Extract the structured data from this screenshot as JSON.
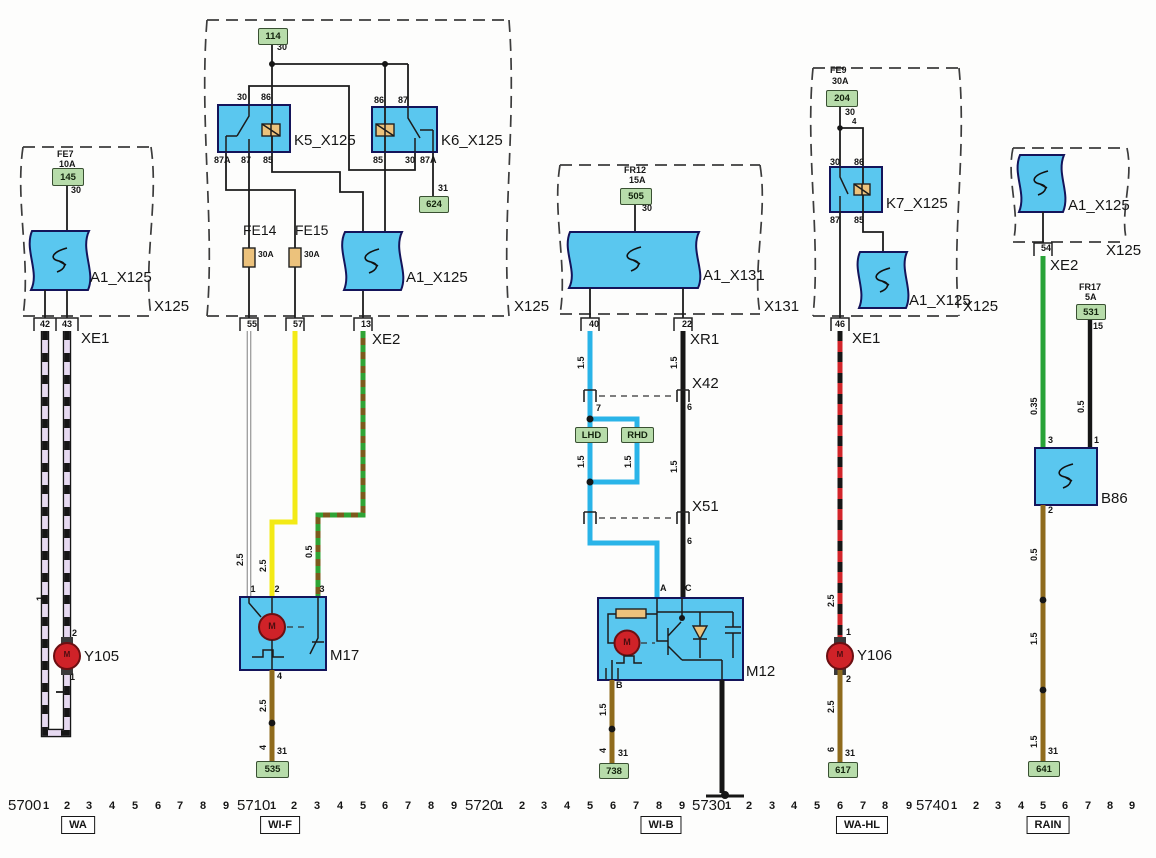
{
  "palette": {
    "bluebox": "#5ac7ef",
    "tan_fuse": "#ecc27c",
    "green_label_bg": "#b7dcaa",
    "lavender_wire": "#e6d9f0",
    "yellow_wire": "#f3ea16",
    "blue_wire": "#2ab4e8",
    "green_wire": "#28a337",
    "brown_wire": "#8f6b1d",
    "red_wire": "#d2252a",
    "motor_red": "#cf2228"
  },
  "labels": [
    [
      "fuse-label",
      "FE7",
      57,
      150,
      9,
      ""
    ],
    [
      "fuse-label",
      "10A",
      59,
      160,
      9,
      ""
    ],
    [
      "terminal-label",
      "30",
      71,
      186,
      9,
      ""
    ],
    [
      "component-label",
      "A1_X125",
      90,
      270,
      15,
      ""
    ],
    [
      "connector-label",
      "X125",
      154,
      299,
      15,
      ""
    ],
    [
      "pin-label",
      "42",
      45,
      320,
      9,
      "c"
    ],
    [
      "pin-label",
      "43",
      67,
      320,
      9,
      "c"
    ],
    [
      "connector-label",
      "XE1",
      81,
      331,
      15,
      ""
    ],
    [
      "wire-size-label",
      "1",
      36,
      601,
      9,
      "r"
    ],
    [
      "pin-label",
      "2",
      72,
      629,
      9,
      ""
    ],
    [
      "component-label",
      "Y105",
      84,
      649,
      15,
      ""
    ],
    [
      "pin-label",
      "1",
      70,
      673,
      9,
      ""
    ],
    [
      "terminal-label",
      "30",
      277,
      43,
      9,
      ""
    ],
    [
      "component-label",
      "K5_X125",
      294,
      133,
      15,
      ""
    ],
    [
      "component-label",
      "K6_X125",
      441,
      133,
      15,
      ""
    ],
    [
      "terminal-label",
      "30",
      237,
      93,
      9,
      ""
    ],
    [
      "terminal-label",
      "86",
      261,
      93,
      9,
      ""
    ],
    [
      "terminal-label",
      "87A",
      214,
      156,
      9,
      ""
    ],
    [
      "terminal-label",
      "87",
      241,
      156,
      9,
      ""
    ],
    [
      "terminal-label",
      "85",
      263,
      156,
      9,
      ""
    ],
    [
      "terminal-label",
      "86",
      374,
      96,
      9,
      ""
    ],
    [
      "terminal-label",
      "87",
      398,
      96,
      9,
      ""
    ],
    [
      "terminal-label",
      "85",
      373,
      156,
      9,
      ""
    ],
    [
      "terminal-label",
      "30",
      405,
      156,
      9,
      ""
    ],
    [
      "terminal-label",
      "87A",
      420,
      156,
      9,
      ""
    ],
    [
      "ground-terminal-label",
      "31",
      438,
      184,
      9,
      ""
    ],
    [
      "fuse-label",
      "FE14",
      243,
      223,
      14,
      ""
    ],
    [
      "fuse-label",
      "FE15",
      295,
      223,
      14,
      ""
    ],
    [
      "fuse-label",
      "30A",
      258,
      250,
      8.5,
      ""
    ],
    [
      "fuse-label",
      "30A",
      304,
      250,
      8.5,
      ""
    ],
    [
      "component-label",
      "A1_X125",
      406,
      270,
      15,
      ""
    ],
    [
      "connector-label",
      "X125",
      514,
      299,
      15,
      ""
    ],
    [
      "pin-label",
      "55",
      252,
      320,
      9,
      "c"
    ],
    [
      "pin-label",
      "57",
      298,
      320,
      9,
      "c"
    ],
    [
      "pin-label",
      "13",
      366,
      320,
      9,
      "c"
    ],
    [
      "connector-label",
      "XE2",
      372,
      332,
      15,
      ""
    ],
    [
      "wire-size-label",
      "2.5",
      236,
      566,
      9,
      "r"
    ],
    [
      "wire-size-label",
      "2.5",
      259,
      572,
      9,
      "r"
    ],
    [
      "wire-size-label",
      "0.5",
      305,
      558,
      9,
      "r"
    ],
    [
      "pin-label",
      "1",
      253,
      585,
      9,
      "c"
    ],
    [
      "pin-label",
      "2",
      277,
      585,
      9,
      "c"
    ],
    [
      "pin-label",
      "3",
      322,
      585,
      9,
      "c"
    ],
    [
      "component-label",
      "M17",
      330,
      648,
      15,
      ""
    ],
    [
      "pin-label",
      "4",
      277,
      672,
      9,
      ""
    ],
    [
      "wire-size-label",
      "2.5",
      259,
      712,
      9,
      "r"
    ],
    [
      "wire-size-label",
      "4",
      259,
      750,
      9,
      "r"
    ],
    [
      "ground-terminal-label",
      "31",
      277,
      747,
      9,
      ""
    ],
    [
      "fuse-label",
      "FR12",
      624,
      166,
      9,
      ""
    ],
    [
      "fuse-label",
      "15A",
      629,
      176,
      9,
      ""
    ],
    [
      "terminal-label",
      "30",
      642,
      204,
      9,
      ""
    ],
    [
      "component-label",
      "A1_X131",
      703,
      268,
      15,
      ""
    ],
    [
      "connector-label",
      "X131",
      764,
      299,
      15,
      ""
    ],
    [
      "pin-label",
      "40",
      594,
      320,
      9,
      "c"
    ],
    [
      "pin-label",
      "22",
      687,
      320,
      9,
      "c"
    ],
    [
      "connector-label",
      "XR1",
      690,
      332,
      15,
      ""
    ],
    [
      "wire-size-label",
      "1.5",
      577,
      369,
      9,
      "r"
    ],
    [
      "wire-size-label",
      "1.5",
      670,
      369,
      9,
      "r"
    ],
    [
      "connector-label",
      "X42",
      692,
      376,
      15,
      ""
    ],
    [
      "pin-label",
      "7",
      596,
      404,
      9,
      ""
    ],
    [
      "pin-label",
      "6",
      687,
      403,
      9,
      ""
    ],
    [
      "wire-size-label",
      "1.5",
      577,
      468,
      9,
      "r"
    ],
    [
      "wire-size-label",
      "1.5",
      624,
      468,
      9,
      "r"
    ],
    [
      "wire-size-label",
      "1.5",
      670,
      473,
      9,
      "r"
    ],
    [
      "connector-label",
      "X51",
      692,
      499,
      15,
      ""
    ],
    [
      "pin-label",
      "6",
      687,
      537,
      9,
      ""
    ],
    [
      "pin-label",
      "A",
      660,
      584,
      9,
      ""
    ],
    [
      "pin-label",
      "C",
      685,
      584,
      9,
      ""
    ],
    [
      "component-label",
      "M12",
      746,
      664,
      15,
      ""
    ],
    [
      "pin-label",
      "B",
      616,
      681,
      9,
      ""
    ],
    [
      "wire-size-label",
      "1.5",
      599,
      716,
      9,
      "r"
    ],
    [
      "wire-size-label",
      "4",
      599,
      753,
      9,
      "r"
    ],
    [
      "ground-terminal-label",
      "31",
      618,
      749,
      9,
      ""
    ],
    [
      "fuse-label",
      "FE9",
      830,
      66,
      9,
      ""
    ],
    [
      "fuse-label",
      "30A",
      832,
      77,
      9,
      ""
    ],
    [
      "terminal-label",
      "30",
      845,
      108,
      9,
      ""
    ],
    [
      "wire-size-label",
      "4",
      852,
      118,
      8,
      ""
    ],
    [
      "terminal-label",
      "30",
      830,
      158,
      9,
      ""
    ],
    [
      "terminal-label",
      "86",
      854,
      158,
      9,
      ""
    ],
    [
      "component-label",
      "K7_X125",
      886,
      196,
      15,
      ""
    ],
    [
      "terminal-label",
      "87",
      830,
      216,
      9,
      ""
    ],
    [
      "terminal-label",
      "85",
      854,
      216,
      9,
      ""
    ],
    [
      "component-label",
      "A1_X125",
      909,
      293,
      15,
      ""
    ],
    [
      "connector-label",
      "X125",
      963,
      299,
      15,
      ""
    ],
    [
      "pin-label",
      "46",
      840,
      320,
      9,
      "c"
    ],
    [
      "connector-label",
      "XE1",
      852,
      331,
      15,
      ""
    ],
    [
      "wire-size-label",
      "2.5",
      827,
      607,
      9,
      "r"
    ],
    [
      "pin-label",
      "1",
      846,
      628,
      9,
      ""
    ],
    [
      "component-label",
      "Y106",
      857,
      648,
      15,
      ""
    ],
    [
      "pin-label",
      "2",
      846,
      675,
      9,
      ""
    ],
    [
      "wire-size-label",
      "2.5",
      827,
      713,
      9,
      "r"
    ],
    [
      "wire-size-label",
      "6",
      827,
      752,
      9,
      "r"
    ],
    [
      "ground-terminal-label",
      "31",
      845,
      749,
      9,
      ""
    ],
    [
      "component-label",
      "A1_X125",
      1068,
      198,
      15,
      ""
    ],
    [
      "connector-label",
      "X125",
      1106,
      243,
      15,
      ""
    ],
    [
      "pin-label",
      "54",
      1046,
      244,
      9,
      "c"
    ],
    [
      "connector-label",
      "XE2",
      1050,
      258,
      15,
      ""
    ],
    [
      "fuse-label",
      "FR17",
      1079,
      283,
      9,
      ""
    ],
    [
      "fuse-label",
      "5A",
      1085,
      293,
      9,
      ""
    ],
    [
      "terminal-label",
      "15",
      1093,
      322,
      9,
      ""
    ],
    [
      "wire-size-label",
      "0.35",
      1030,
      415,
      9,
      "r"
    ],
    [
      "wire-size-label",
      "0.5",
      1077,
      413,
      9,
      "r"
    ],
    [
      "pin-label",
      "3",
      1048,
      436,
      9,
      ""
    ],
    [
      "pin-label",
      "1",
      1094,
      436,
      9,
      ""
    ],
    [
      "component-label",
      "B86",
      1101,
      491,
      15,
      ""
    ],
    [
      "pin-label",
      "2",
      1048,
      506,
      9,
      ""
    ],
    [
      "wire-size-label",
      "0.5",
      1030,
      561,
      9,
      "r"
    ],
    [
      "wire-size-label",
      "1.5",
      1030,
      645,
      9,
      "r"
    ],
    [
      "wire-size-label",
      "1.5",
      1030,
      748,
      9,
      "r"
    ],
    [
      "ground-terminal-label",
      "31",
      1048,
      747,
      9,
      ""
    ],
    [
      "motor-letter",
      "M",
      67,
      651,
      8,
      "cm"
    ],
    [
      "motor-letter",
      "M",
      272,
      622,
      9,
      "cm"
    ],
    [
      "motor-letter",
      "M",
      627,
      638,
      9,
      "cm"
    ],
    [
      "motor-letter",
      "M",
      840,
      651,
      8,
      "cm"
    ]
  ],
  "green_boxes": [
    [
      "supply-code-145",
      "145",
      52,
      168,
      30,
      16
    ],
    [
      "supply-code-114",
      "114",
      258,
      28,
      28,
      15
    ],
    [
      "ground-code-624",
      "624",
      419,
      196,
      28,
      15
    ],
    [
      "supply-code-505",
      "505",
      620,
      188,
      30,
      15
    ],
    [
      "supply-code-204",
      "204",
      826,
      90,
      30,
      15
    ],
    [
      "supply-code-531",
      "531",
      1076,
      304,
      28,
      14
    ],
    [
      "ground-code-535",
      "535",
      256,
      761,
      31,
      15
    ],
    [
      "ground-code-738",
      "738",
      599,
      763,
      28,
      14
    ],
    [
      "ground-code-617",
      "617",
      828,
      762,
      28,
      14
    ],
    [
      "ground-code-641",
      "641",
      1028,
      761,
      30,
      14
    ],
    [
      "variant-lhd",
      "LHD",
      575,
      427,
      31,
      14
    ],
    [
      "variant-rhd",
      "RHD",
      621,
      427,
      31,
      14
    ]
  ],
  "ruler": {
    "groups": [
      {
        "base": "5700",
        "base_x": 8,
        "ticks": [
          [
            "1",
            46
          ],
          [
            "2",
            67
          ],
          [
            "3",
            89
          ],
          [
            "4",
            112
          ],
          [
            "5",
            135
          ],
          [
            "6",
            158
          ],
          [
            "7",
            180
          ],
          [
            "8",
            203
          ],
          [
            "9",
            226
          ]
        ]
      },
      {
        "base": "5710",
        "base_x": 237,
        "ticks": [
          [
            "1",
            273
          ],
          [
            "2",
            294
          ],
          [
            "3",
            317
          ],
          [
            "4",
            340
          ],
          [
            "5",
            363
          ],
          [
            "6",
            385
          ],
          [
            "7",
            408
          ],
          [
            "8",
            431
          ],
          [
            "9",
            454
          ]
        ]
      },
      {
        "base": "5720",
        "base_x": 465,
        "ticks": [
          [
            "1",
            500
          ],
          [
            "2",
            522
          ],
          [
            "3",
            544
          ],
          [
            "4",
            567
          ],
          [
            "5",
            590
          ],
          [
            "6",
            613
          ],
          [
            "7",
            636
          ],
          [
            "8",
            659
          ],
          [
            "9",
            682
          ]
        ]
      },
      {
        "base": "5730",
        "base_x": 692,
        "ticks": [
          [
            "1",
            728
          ],
          [
            "2",
            749
          ],
          [
            "3",
            772
          ],
          [
            "4",
            794
          ],
          [
            "5",
            817
          ],
          [
            "6",
            840
          ],
          [
            "7",
            863
          ],
          [
            "8",
            885
          ],
          [
            "9",
            909
          ]
        ]
      },
      {
        "base": "5740",
        "base_x": 916,
        "ticks": [
          [
            "1",
            954
          ],
          [
            "2",
            976
          ],
          [
            "3",
            998
          ],
          [
            "4",
            1021
          ],
          [
            "5",
            1043
          ],
          [
            "6",
            1065
          ],
          [
            "7",
            1088
          ],
          [
            "8",
            1110
          ],
          [
            "9",
            1132
          ]
        ]
      }
    ],
    "base_y": 798,
    "tick_y": 801
  },
  "function_labels": [
    {
      "text": "WA",
      "x": 78
    },
    {
      "text": "WI-F",
      "x": 280
    },
    {
      "text": "WI-B",
      "x": 661
    },
    {
      "text": "WA-HL",
      "x": 862
    },
    {
      "text": "RAIN",
      "x": 1048
    }
  ],
  "function_label_y": 816
}
